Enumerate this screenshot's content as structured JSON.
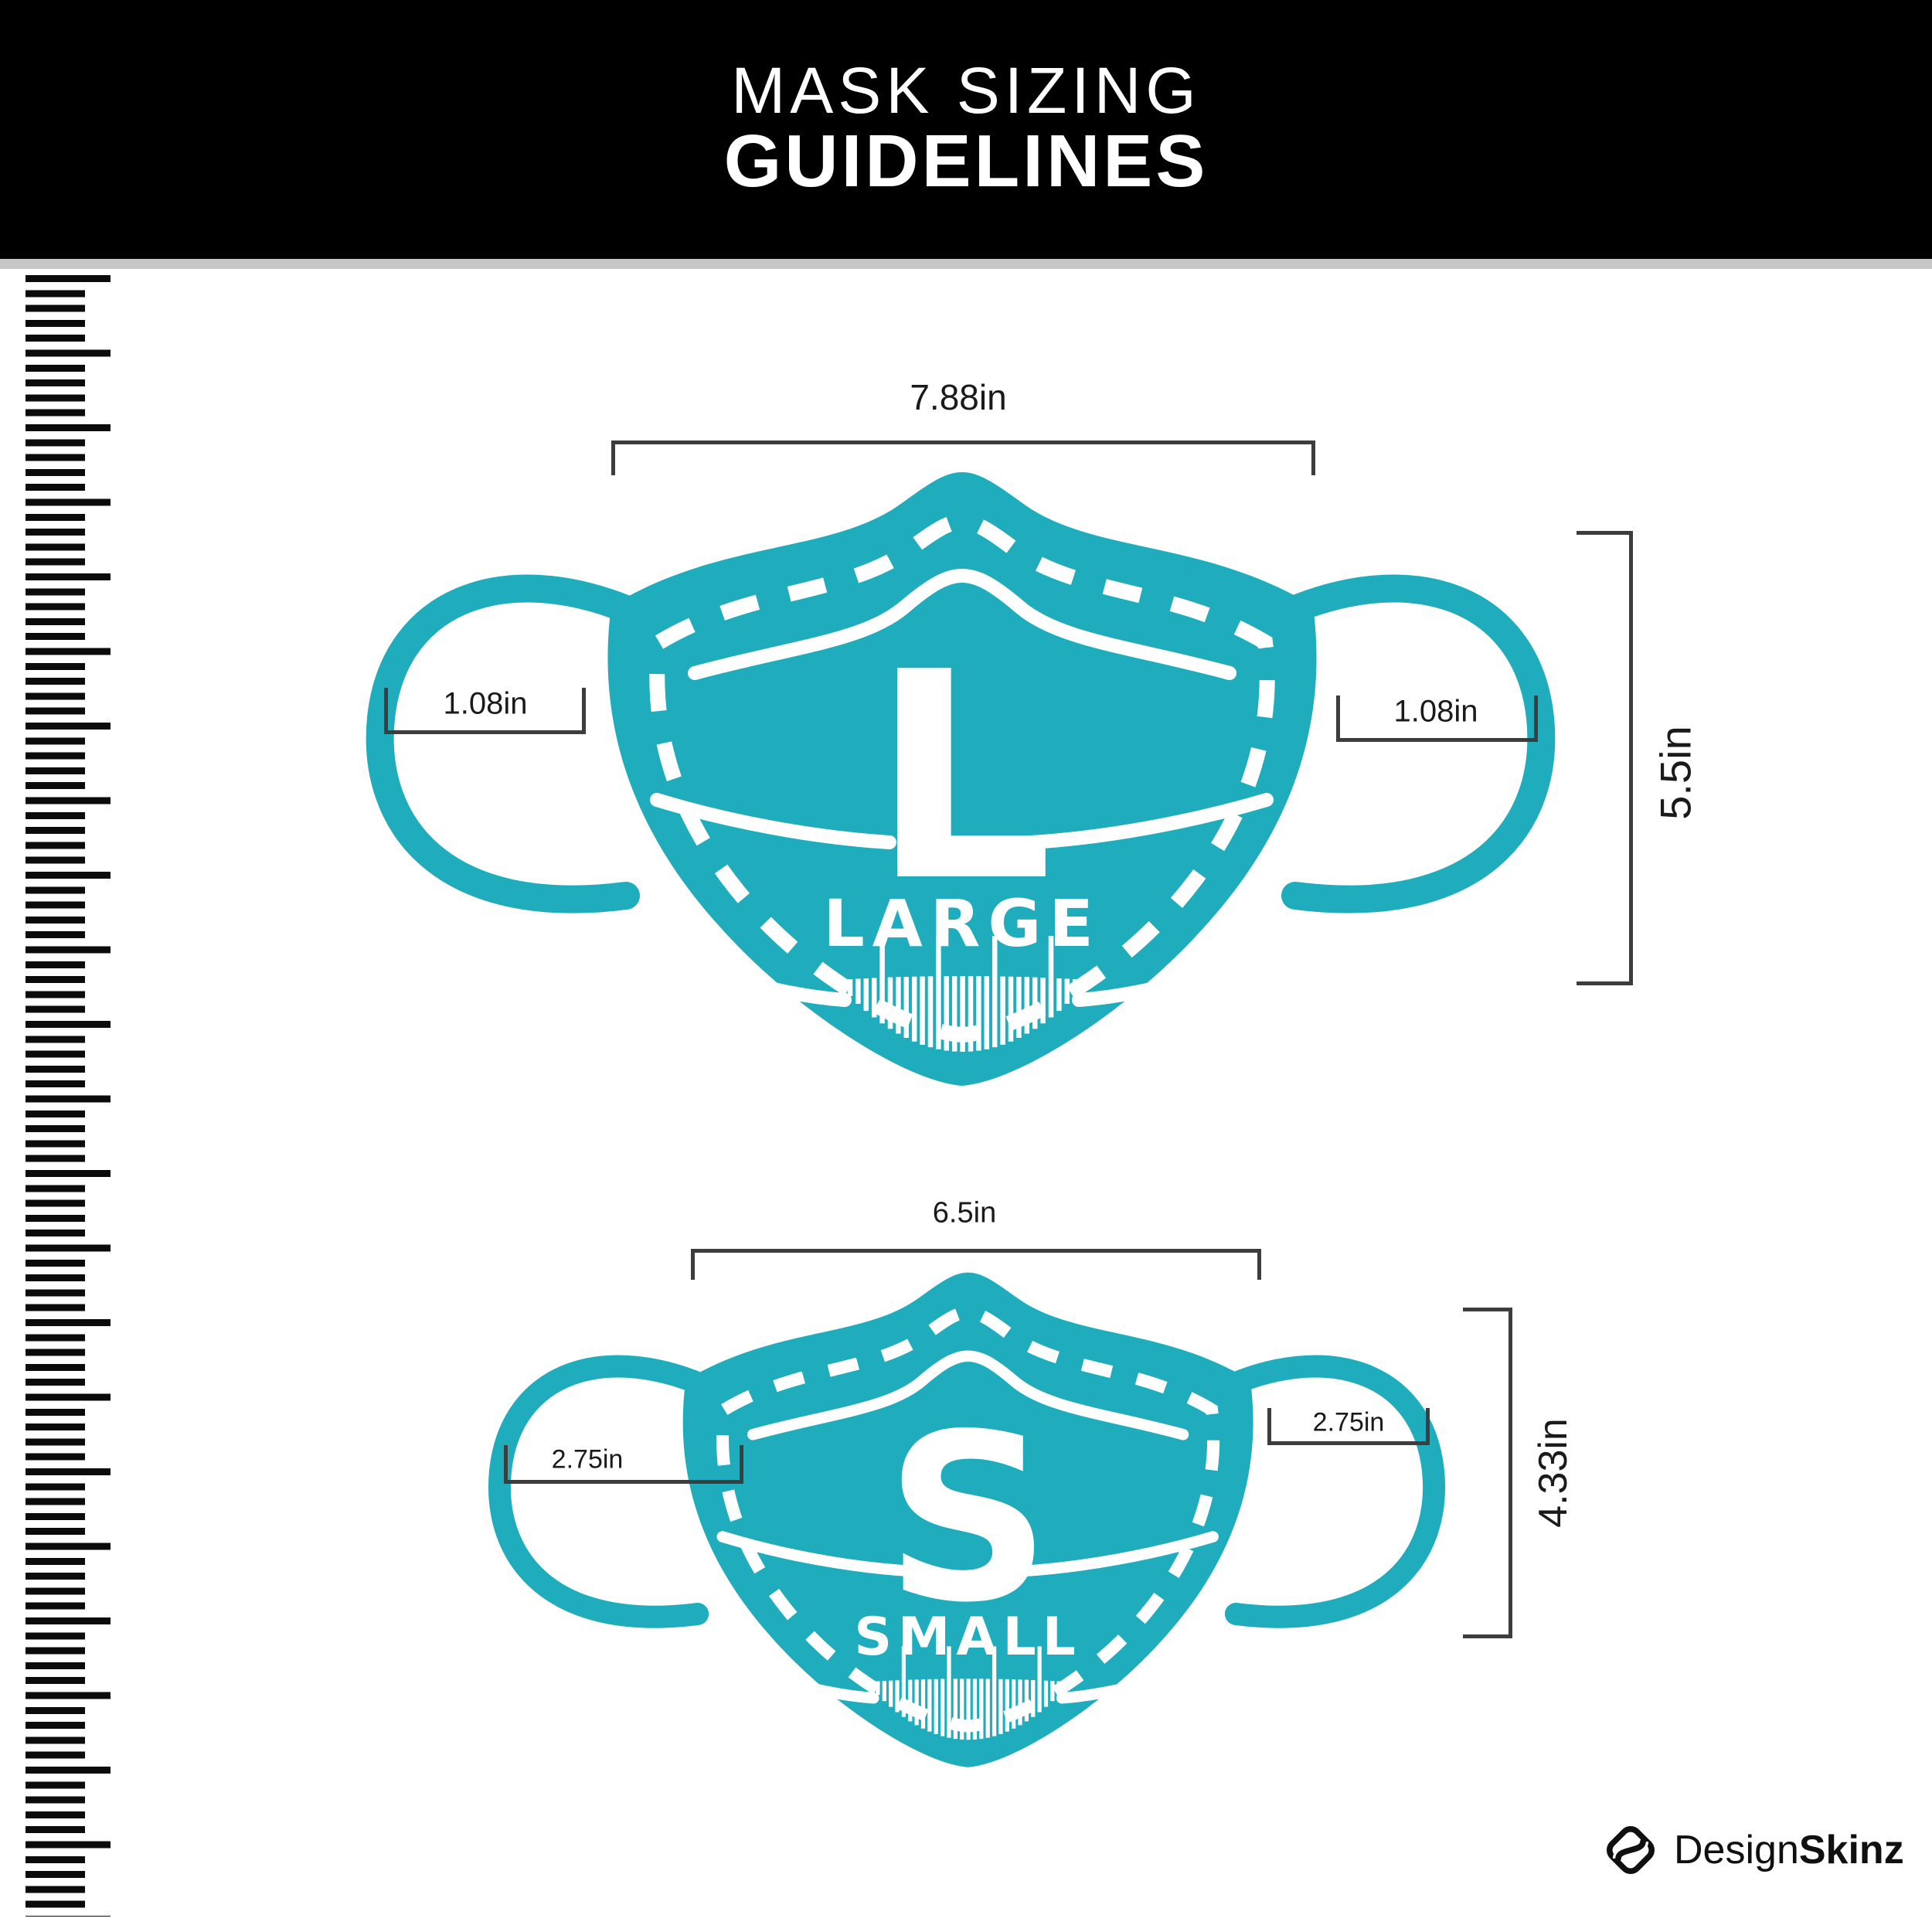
{
  "header": {
    "title_line1": "MASK SIZING",
    "title_line2": "GUIDELINES"
  },
  "colors": {
    "header_bg": "#000000",
    "header_text": "#ffffff",
    "divider_gray": "#c6c6c6",
    "mask_teal": "#1fadbd",
    "mask_markings": "#ffffff",
    "dimension_line": "#3d3d3d",
    "label_text": "#1a1a1a",
    "ruler_tick": "#0b0b0b"
  },
  "masks": [
    {
      "id": "large",
      "letter": "L",
      "size_word": "LARGE",
      "width_label": "7.88in",
      "height_label": "5.5in",
      "left_ear_label": "1.08in",
      "right_ear_label": "1.08in"
    },
    {
      "id": "small",
      "letter": "S",
      "size_word": "SMALL",
      "width_label": "6.5in",
      "height_label": "4.33in",
      "left_ear_label": "2.75in",
      "right_ear_label": "2.75in"
    }
  ],
  "footer": {
    "brand_regular": "Design",
    "brand_bold": "Skinz"
  }
}
